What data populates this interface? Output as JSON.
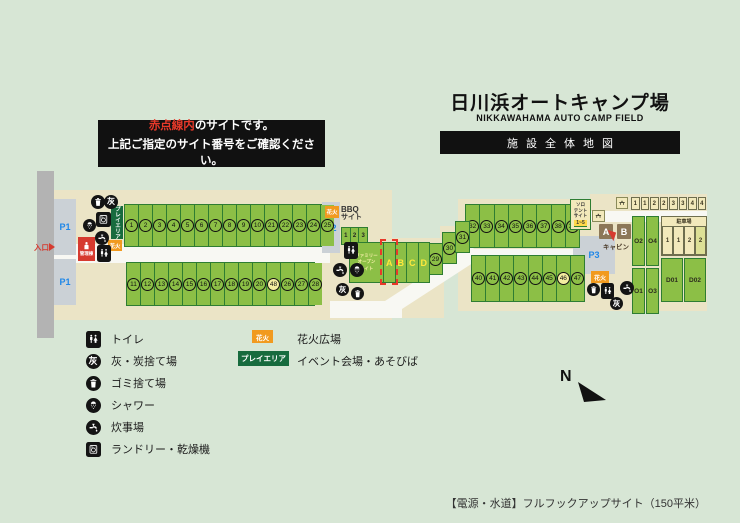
{
  "header": {
    "title": "日川浜オートキャンプ場",
    "subtitle": "NIKKAWAHAMA AUTO CAMP FIELD",
    "banner": "施設全体地図"
  },
  "notice": {
    "highlight": "赤点線内",
    "line1_rest": "のサイトです。",
    "line2": "上記ご指定のサイト番号をご確認ください。"
  },
  "map": {
    "entrance": "入口",
    "admin": "管理棟",
    "play_area": "プレイエリア",
    "hanabi": "花火",
    "p1": "P1",
    "p2": "P2",
    "p3": "P3",
    "bbq_line1": "BBQ",
    "bbq_line2": "サイト",
    "cabin_caption": "キャビン",
    "parking_title": "駐車場",
    "solo_lines": [
      "ソロ",
      "テント",
      "サイト"
    ],
    "solo_range": "1~5",
    "family_lines": [
      "ファミリー",
      "オープン",
      "サイト"
    ],
    "ash_char": "灰",
    "rows": {
      "top": [
        "1",
        "2",
        "3",
        "4",
        "5",
        "6",
        "7",
        "8",
        "9",
        "10",
        "21",
        "22",
        "23",
        "24",
        "25"
      ],
      "bottom": [
        "11",
        "12",
        "13",
        "14",
        "15",
        "16",
        "17",
        "18",
        "19",
        "20",
        "48",
        "26",
        "27",
        "28"
      ],
      "steps": [
        "29",
        "30",
        "31"
      ],
      "right_top": [
        "32",
        "33",
        "34",
        "35",
        "36",
        "37",
        "38",
        "39"
      ],
      "right_bottom": [
        "40",
        "41",
        "42",
        "43",
        "44",
        "45",
        "46",
        "47"
      ],
      "special": [
        "46",
        "48"
      ],
      "bbq": [
        "1",
        "2",
        "3"
      ],
      "family": [
        "A",
        "B",
        "C",
        "D"
      ],
      "right_cells": [
        "1",
        "1",
        "2",
        "2",
        "3",
        "3",
        "4",
        "4"
      ],
      "parking_cells": [
        "1",
        "1",
        "2",
        "2"
      ],
      "o_top": [
        "O2",
        "O4"
      ],
      "o_bottom": [
        "O1",
        "O3"
      ],
      "d_cells": [
        "D01",
        "D02"
      ],
      "cabins": [
        "A",
        "B"
      ]
    }
  },
  "legend": {
    "items": [
      {
        "icon": "toilet",
        "label": "トイレ"
      },
      {
        "icon": "ash",
        "label": "灰・炭捨て場"
      },
      {
        "icon": "bin",
        "label": "ゴミ捨て場"
      },
      {
        "icon": "shower",
        "label": "シャワー"
      },
      {
        "icon": "faucet",
        "label": "炊事場"
      },
      {
        "icon": "laundry",
        "label": "ランドリー・乾燥機"
      }
    ],
    "badges": [
      {
        "badge": "花火",
        "label": "花火広場"
      },
      {
        "badge": "プレイエリア",
        "label": "イベント会場・あそびば"
      }
    ]
  },
  "compass": {
    "label": "N"
  },
  "footer": {
    "note": "【電源・水道】フルフックアップサイト（150平米）"
  },
  "colors": {
    "background": "#d7e6d5",
    "map_beige": "#ebe4c6",
    "site_green": "#8cbf46",
    "site_border": "#2e7d32",
    "accent_red": "#d63a2f",
    "dashed_red": "#e8392a",
    "hanabi_orange": "#f19a1f",
    "play_green": "#176b3e",
    "parking_blue": "#1f87e8",
    "tan": "#f2e9bb",
    "cabin_brown": "#8c7758",
    "special_yellow": "#f4eda0"
  }
}
